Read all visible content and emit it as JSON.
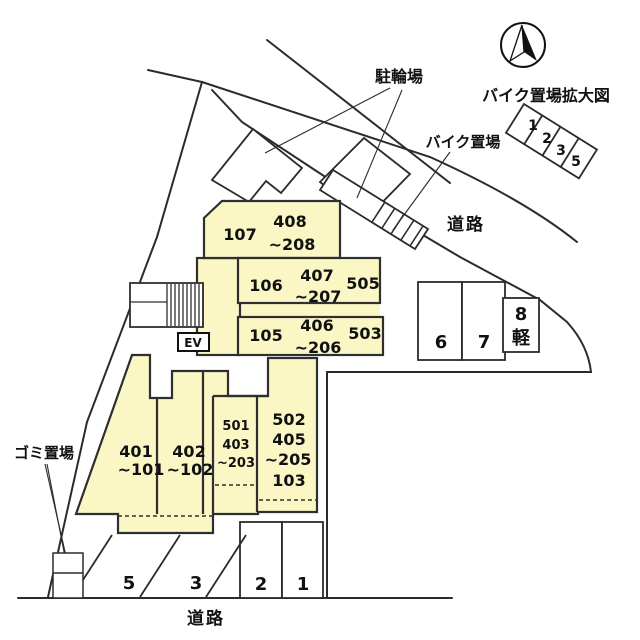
{
  "colors": {
    "building_fill": "#faf7c5",
    "line": "#2b2b2b",
    "text": "#111111"
  },
  "labels": {
    "bicycle_parking": "駐輪場",
    "bike_parking": "バイク置場",
    "bike_parking_enlarged": "バイク置場拡大図",
    "road_top": "道路",
    "road_bottom": "道路",
    "garbage_area": "ゴミ置場",
    "elevator": "EV"
  },
  "building_units": {
    "top_row": {
      "left": "107",
      "stack_top": "408",
      "stack_bottom": "~208"
    },
    "middle_row": {
      "left": "106",
      "stack_top": "407",
      "stack_bottom": "~207",
      "right": "505"
    },
    "lower_row": {
      "left": "105",
      "stack_top": "406",
      "stack_bottom": "~206",
      "right": "503"
    },
    "col_401": {
      "l1": "401",
      "l2": "~101"
    },
    "col_402": {
      "l1": "402",
      "l2": "~102"
    },
    "col_501": {
      "l1": "501",
      "l2": "403",
      "l3": "~203"
    },
    "col_502": {
      "l1": "502",
      "l2": "405",
      "l3": "~205",
      "l4": "103"
    }
  },
  "parking_spaces": {
    "p1": "1",
    "p2": "2",
    "p3": "3",
    "p5": "5",
    "p6": "6",
    "p7": "7",
    "p8": "8",
    "p8_type": "軽"
  },
  "bike_spaces": {
    "s1": "1",
    "s2": "2",
    "s3": "3",
    "s5": "5"
  }
}
